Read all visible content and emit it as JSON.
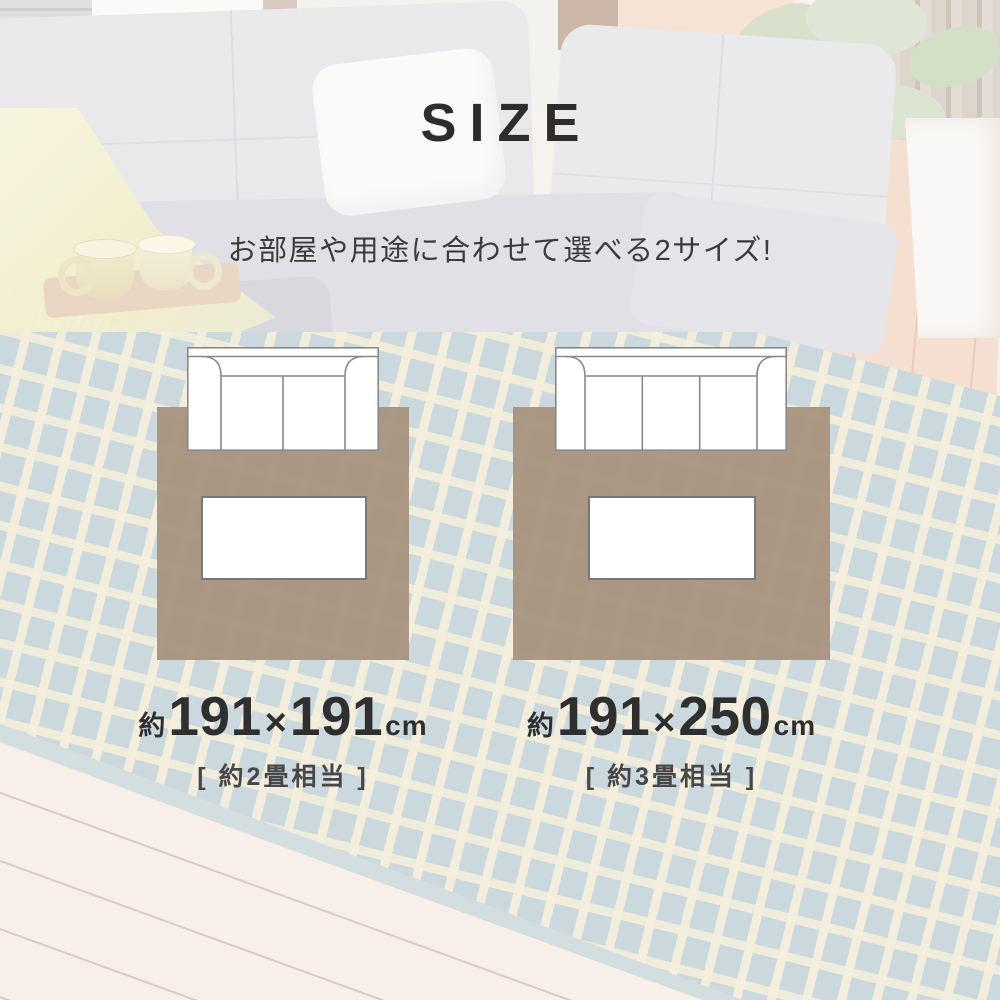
{
  "header": {
    "title": "SIZE",
    "subtitle": "お部屋や用途に合わせて選べる2サイズ!"
  },
  "sizes": [
    {
      "approx": "約",
      "width": "191",
      "times": "×",
      "depth": "191",
      "unit": "cm",
      "tatami": "[ 約2畳相当 ]",
      "sofa_seats": 2
    },
    {
      "approx": "約",
      "width": "191",
      "times": "×",
      "depth": "250",
      "unit": "cm",
      "tatami": "[ 約3畳相当 ]",
      "sofa_seats": 3
    }
  ],
  "colors": {
    "rug_brown": "#a6917d",
    "text_dark": "#2f2f2f",
    "text_gray": "#474747",
    "photo_rug_blue": "#cbd8de",
    "photo_rug_cream": "#f2ecda"
  }
}
